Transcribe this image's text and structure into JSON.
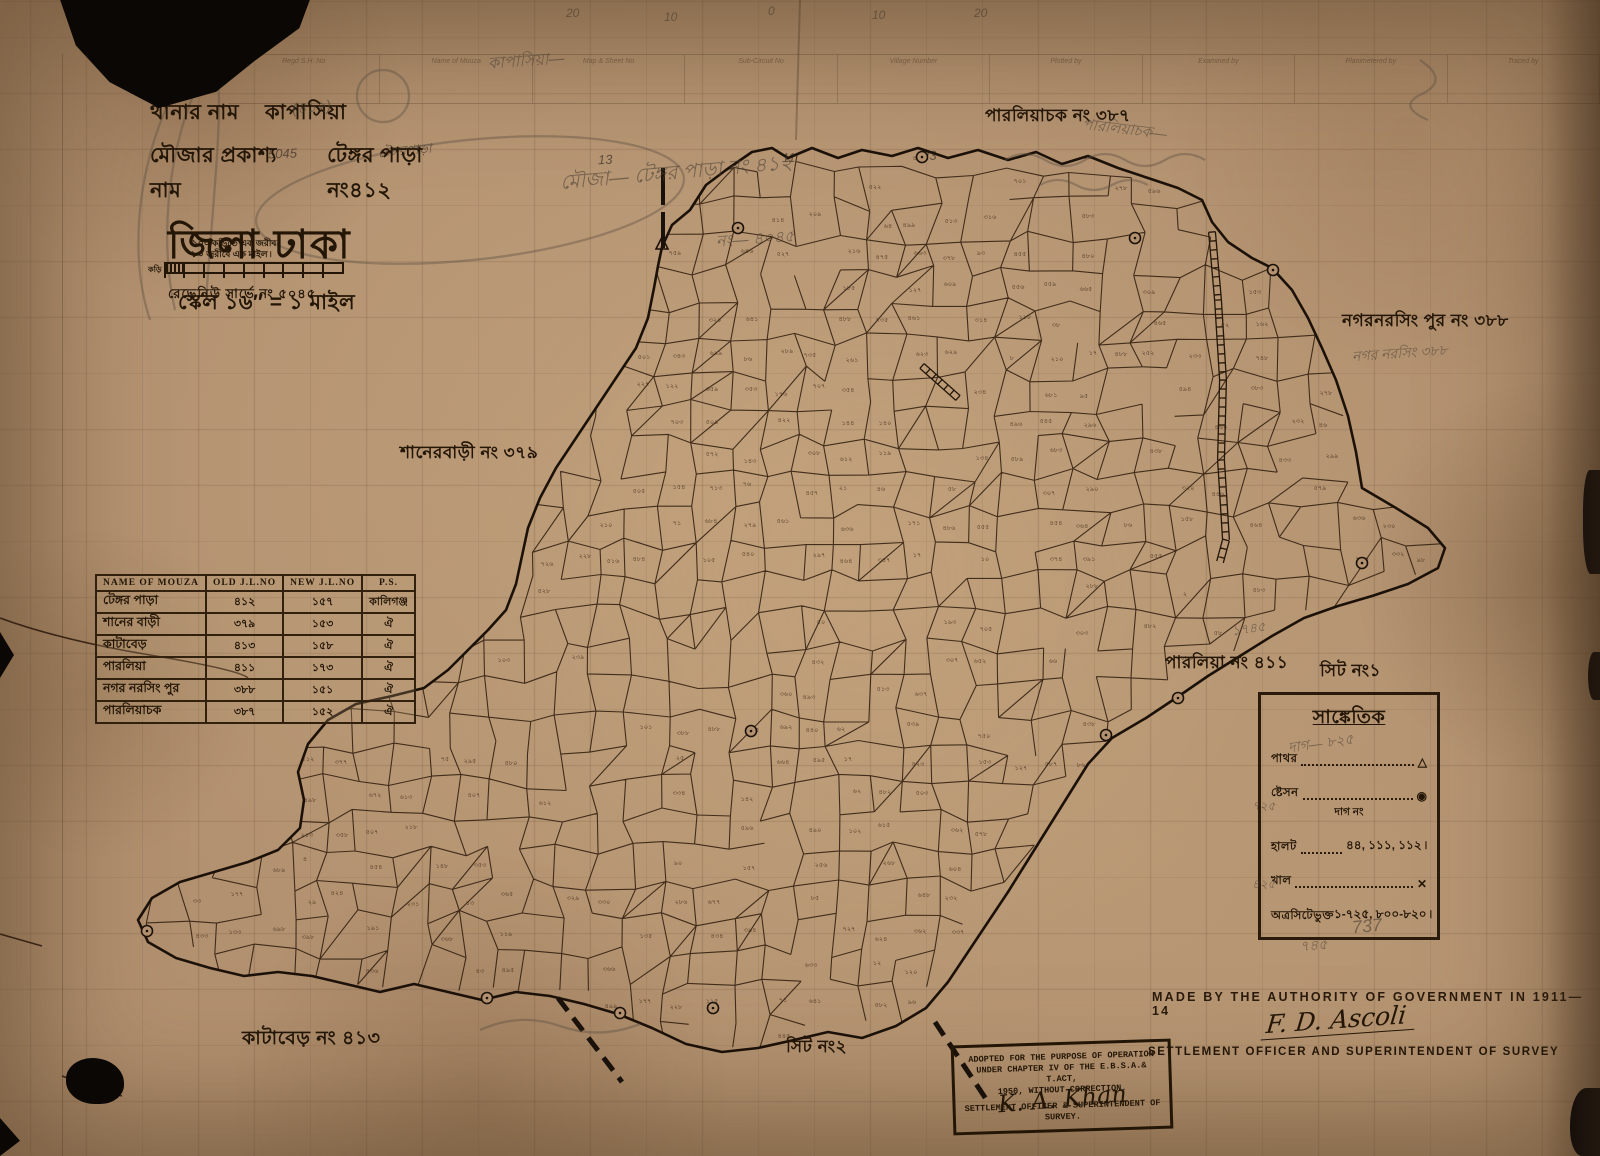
{
  "header": {
    "thana_label": "থানার নাম",
    "thana_value": "কাপাসিয়া",
    "mouza_label": "মৌজার প্রকাশ্য নাম",
    "mouza_value": "টেঙ্গর পাড়া নং৪১২",
    "district_title": "জিলা ঢাকা",
    "scale_line": "স্কেল ১৬″ = ১ মাইল"
  },
  "scale_bar": {
    "note1": "১০০ কড়িতে এক জরীব ৷",
    "note2": "৮০ জরীবে এক মাইল ৷",
    "left_label": "কড়ি",
    "survey_no": "রেভেনিউ সার্ভে নং ৫০৪৫"
  },
  "mouza_table": {
    "headers": [
      "NAME OF MOUZA",
      "OLD J.L.NO",
      "NEW J.L.NO",
      "P.S."
    ],
    "rows": [
      [
        "টেঙ্গর পাড়া",
        "৪১২",
        "১৫৭",
        "কালিগঞ্জ"
      ],
      [
        "শানের বাড়ী",
        "৩৭৯",
        "১৫৩",
        "ঐ"
      ],
      [
        "কাটাবেড়",
        "৪১৩",
        "১৫৮",
        "ঐ"
      ],
      [
        "পারলিয়া",
        "৪১১",
        "১৭৩",
        "ঐ"
      ],
      [
        "নগর নরসিং পুর",
        "৩৮৮",
        "১৫১",
        "ঐ"
      ],
      [
        "পারলিয়াচক",
        "৩৮৭",
        "১৫২",
        "ঐ"
      ]
    ]
  },
  "legend": {
    "title": "সাঙ্কেতিক",
    "rows": [
      {
        "label": "পাথর",
        "leader": true,
        "symbol": "△",
        "value": "",
        "sublabel": ""
      },
      {
        "label": "ষ্টেসন",
        "leader": true,
        "symbol": "◉",
        "value": "",
        "sublabel": "দাগ নং"
      },
      {
        "label": "হালট",
        "leader": true,
        "symbol": "",
        "value": "৪৪, ১১১, ১১২ ৷",
        "sublabel": ""
      },
      {
        "label": "খাল",
        "leader": true,
        "symbol": "✕",
        "value": "",
        "sublabel": ""
      },
      {
        "label": "অত্রসিটেভুক্ত",
        "leader": false,
        "symbol": "",
        "value": "১-৭২৫, ৮০০-৮২০ ৷",
        "sublabel": ""
      }
    ]
  },
  "region_labels": {
    "parliachak": "পারলিয়াচক নং ৩৮৭",
    "nagarnarsingpur": "নগরনরসিং পুর নং ৩৮৮",
    "shanerbari": "শানেরবাড়ী নং ৩৭৯",
    "parlia": "পারলিয়া নং ৪১১",
    "sheet1": "সিট নং১",
    "katabedh": "কাটাবেড় নং ৪১৩",
    "sheet2": "সিট নং২"
  },
  "authority": {
    "made_by": "MADE BY THE AUTHORITY OF GOVERNMENT IN 1911—14",
    "signature": "F. D. Ascoli",
    "officer_line": "SETTLEMENT OFFICER AND SUPERINTENDENT OF SURVEY"
  },
  "stamp": {
    "line1": "ADOPTED FOR THE PURPOSE OF OPERATION",
    "line2": "UNDER CHAPTER IV OF THE E.B.S.A.& T.ACT,",
    "line3": "1950, WITHOUT CORRECTION.",
    "signature": "K. A. Khan",
    "line4": "SETTLEMENT OFFICER & SUPERINTENDENT OF",
    "line5": "SURVEY."
  },
  "top_form": {
    "ruler_numbers": [
      "20",
      "10",
      "0",
      "10",
      "20"
    ],
    "columns": [
      "Regd S.H. No",
      "Name of Mouza",
      "Map & Sheet No",
      "Sub-Circuit No",
      "Village Number",
      "Plotted by",
      "Examined by",
      "Planimetered by",
      "Traced by"
    ],
    "entries": [
      "5045",
      "টেঙ্গরপাড়া",
      "13",
      "11",
      "23"
    ]
  },
  "pencil_notes": [
    {
      "text": "(৪১২)"
    },
    {
      "text": "কাপাসিয়া—"
    },
    {
      "text": "মৌজা— টেঙ্গর পাড়া নং ৪১২"
    },
    {
      "text": "নং— ৪০৪৫"
    },
    {
      "text": "পারলিয়াচক—"
    },
    {
      "text": "নগর নরসিং ৩৮৮"
    },
    {
      "text": "দাগ— ৮২৫"
    },
    {
      "text": "737"
    },
    {
      "text": "৭৪৫"
    },
    {
      "text": "১৭৪৫"
    },
    {
      "text": "৭২৫"
    },
    {
      "text": "৪২৫"
    }
  ]
}
